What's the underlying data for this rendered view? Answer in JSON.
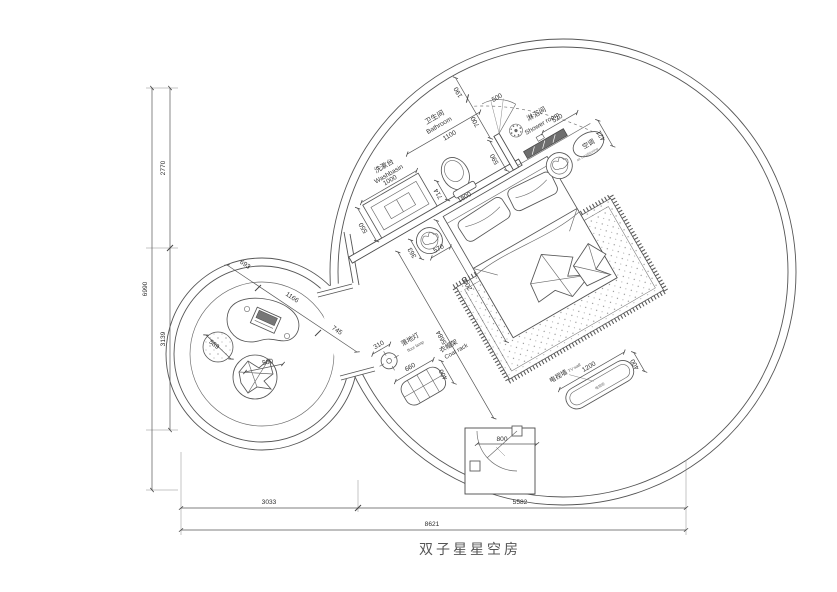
{
  "title": "双子星星空房",
  "rooms": {
    "washbasin": {
      "cn": "洗漱台",
      "en": "Washbasin"
    },
    "bathroom": {
      "cn": "卫生间",
      "en": "Bathroom"
    },
    "shower": {
      "cn": "淋浴间",
      "en": "Shower room"
    },
    "ac": {
      "cn": "空调",
      "en": "air conditioning"
    },
    "floor_lamp": {
      "cn": "落地灯",
      "en": "floor lamp"
    },
    "coat_rack": {
      "cn": "衣帽架",
      "en": "Coat rack"
    },
    "tv_wall": {
      "cn": "电视墙",
      "en": "TV wall"
    },
    "tv_cabinet": {
      "cn": "电视柜"
    }
  },
  "dims": {
    "bath_offset": "190",
    "bath_door": "700",
    "bath_door_leaf": "500",
    "bathroom_width": "1100",
    "washbasin_len": "1000",
    "washbasin_depth": "550",
    "toilet_clear": "714",
    "bath_wall": "1800",
    "shower_wall": "590",
    "bench": "520",
    "ac_depth": "421",
    "side_table_a": "363",
    "side_table_b": "570",
    "bed_len": "2000",
    "room_diag": "5684",
    "lamp_dia": "310",
    "coat_rack_len": "660",
    "coat_rack_depth": "400",
    "tv_len": "1200",
    "tv_depth": "400",
    "entry_door": "800",
    "lounge_a": "693",
    "lounge_b": "1166",
    "lounge_c": "745",
    "pouf_dia": "589",
    "chair_dia": "500",
    "left_top": "2770",
    "left_bottom": "3139",
    "left_total": "6990",
    "bottom_left": "3033",
    "bottom_right": "5582",
    "bottom_total": "8621"
  }
}
